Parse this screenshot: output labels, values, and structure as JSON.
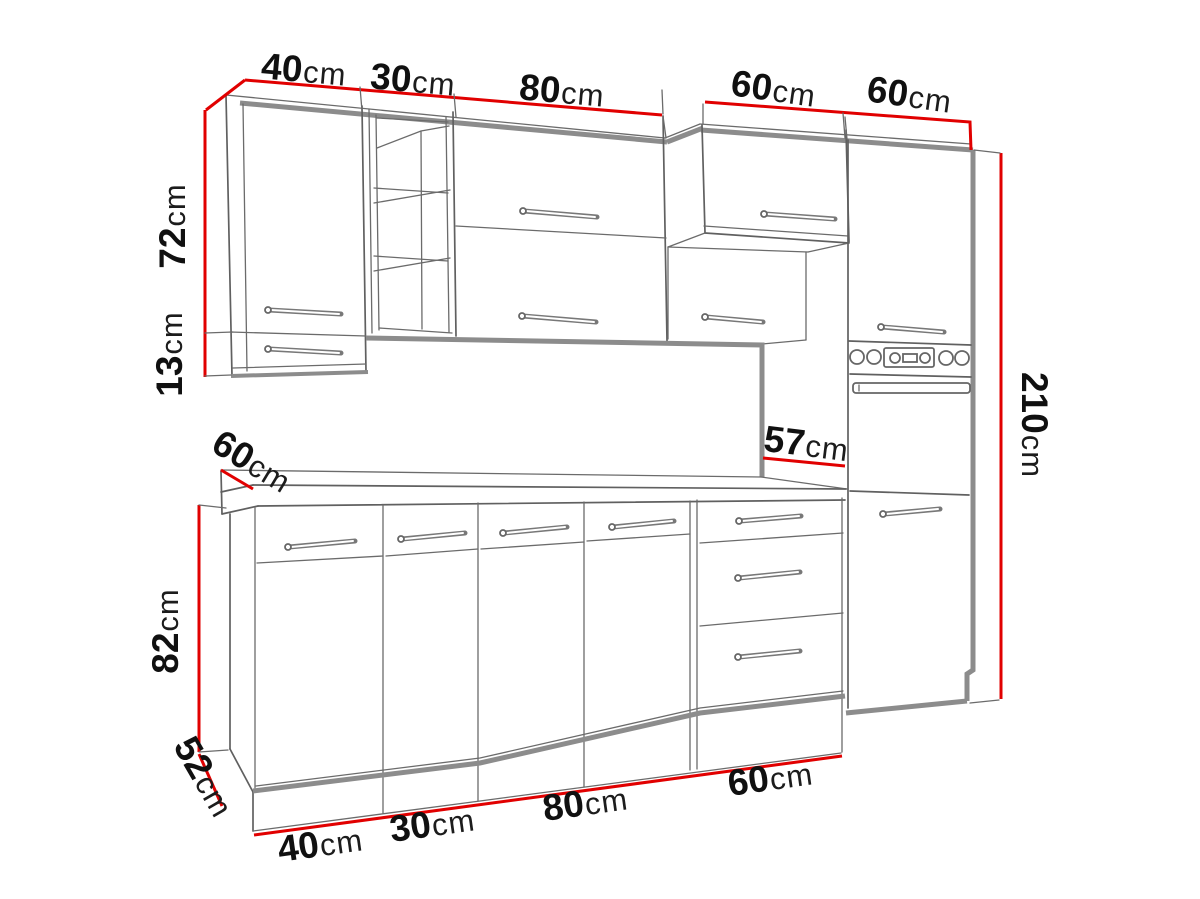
{
  "diagram": {
    "description": "Kitchen cabinet set technical dimension drawing",
    "unit": "cm",
    "colors": {
      "dimension_line": "#e10000",
      "outline_thin": "#606060",
      "outline_thick": "#8c8c8c",
      "label_text": "#101010",
      "background": "#ffffff"
    },
    "labels": {
      "top_40": {
        "num": "40",
        "unit": "cm"
      },
      "top_30": {
        "num": "30",
        "unit": "cm"
      },
      "top_80": {
        "num": "80",
        "unit": "cm"
      },
      "top_60_left": {
        "num": "60",
        "unit": "cm"
      },
      "top_60_right": {
        "num": "60",
        "unit": "cm"
      },
      "left_72": {
        "num": "72",
        "unit": "cm"
      },
      "left_13": {
        "num": "13",
        "unit": "cm"
      },
      "counter_60": {
        "num": "60",
        "unit": "cm"
      },
      "counter_57": {
        "num": "57",
        "unit": "cm"
      },
      "right_210": {
        "num": "210",
        "unit": "cm"
      },
      "left_82": {
        "num": "82",
        "unit": "cm"
      },
      "left_52": {
        "num": "52",
        "unit": "cm"
      },
      "bottom_40": {
        "num": "40",
        "unit": "cm"
      },
      "bottom_30": {
        "num": "30",
        "unit": "cm"
      },
      "bottom_80": {
        "num": "80",
        "unit": "cm"
      },
      "bottom_60": {
        "num": "60",
        "unit": "cm"
      }
    },
    "measurements": {
      "wall_unit_widths_cm": [
        40,
        30,
        80,
        60,
        60
      ],
      "wall_unit_height_cm": 72,
      "wall_unit_lower_extension_cm": 13,
      "worktop_depth_left_cm": 60,
      "worktop_depth_right_cm": 57,
      "base_unit_height_cm": 82,
      "base_unit_depth_cm": 52,
      "total_height_cm": 210,
      "base_unit_widths_cm": [
        40,
        30,
        80,
        60
      ]
    }
  }
}
